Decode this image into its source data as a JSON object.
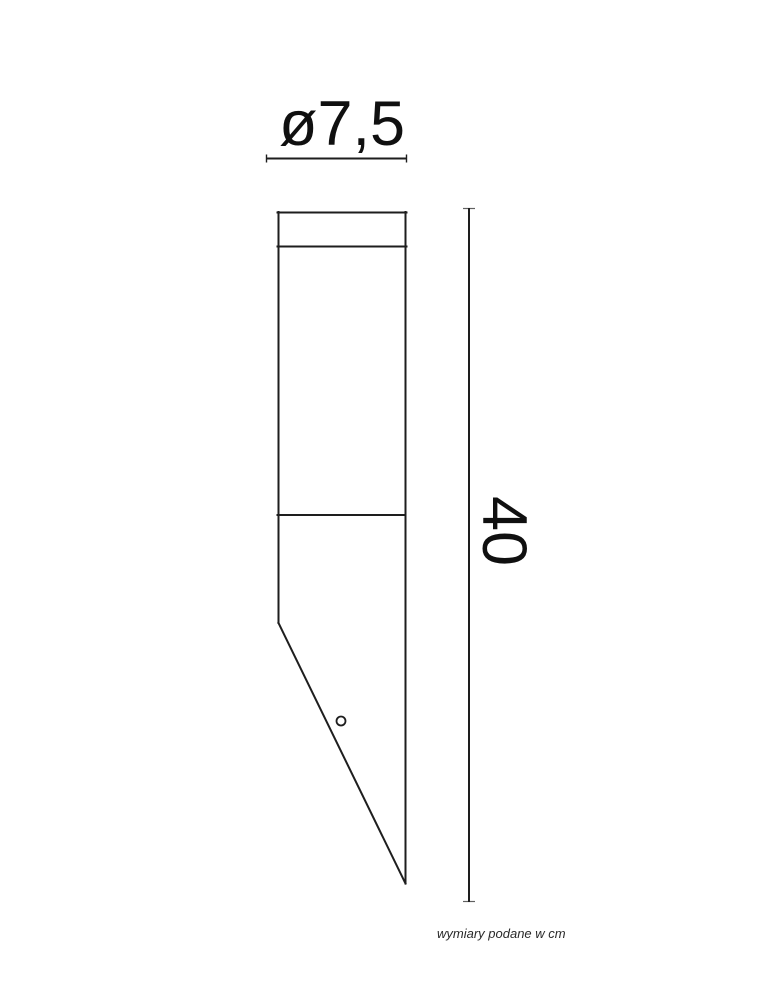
{
  "colors": {
    "background": "#ffffff",
    "line": "#1e1e1e",
    "label_text": "#101010",
    "footnote_text": "#2a2a2a"
  },
  "labels": {
    "diameter": "ø7,5",
    "height": "40",
    "footnote": "wymiary podane w cm"
  }
}
